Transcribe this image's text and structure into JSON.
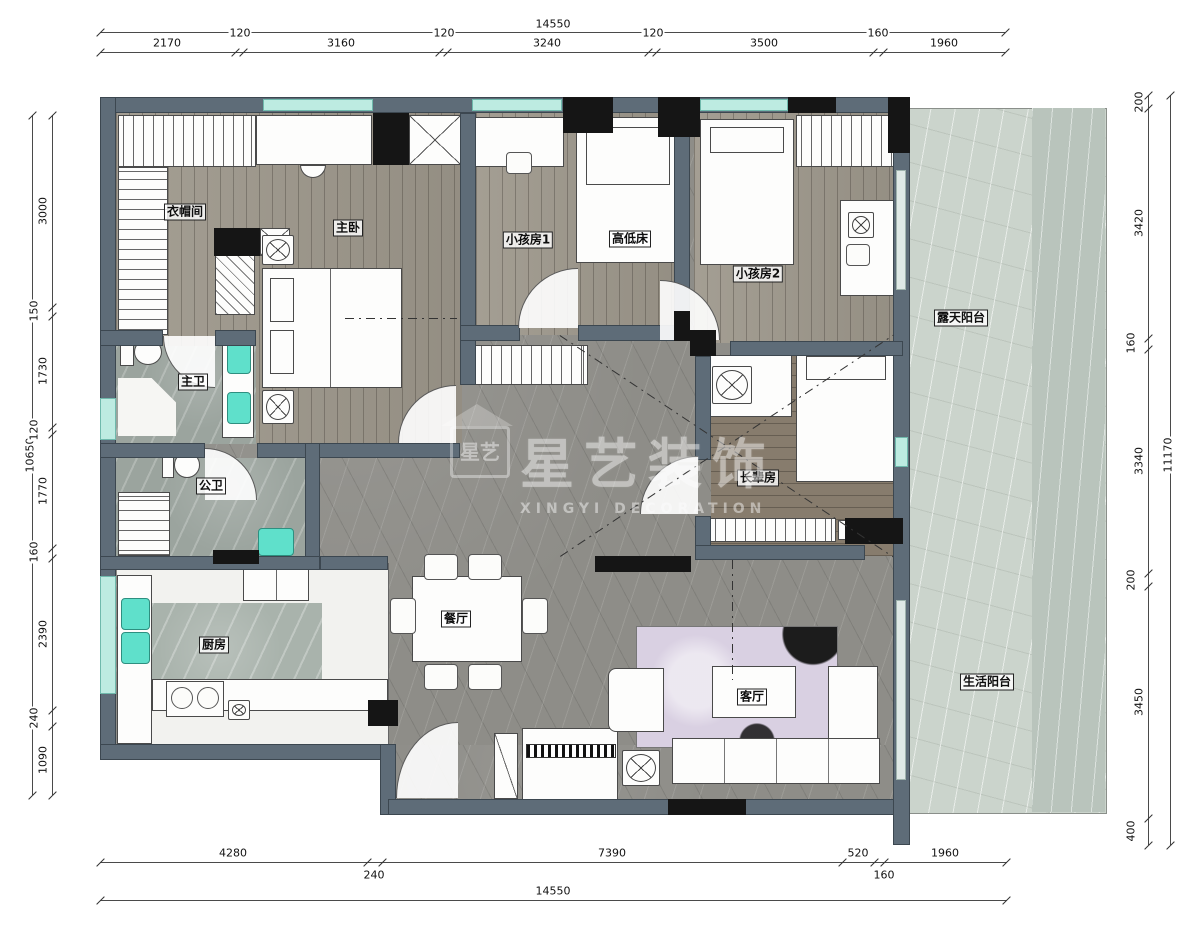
{
  "watermark": {
    "brand": "星艺装饰",
    "subtitle": "XINGYI DECORATION",
    "logo_text": "星艺"
  },
  "rooms": {
    "cloakroom": "衣帽间",
    "master_bedroom": "主卧",
    "kids_room_1": "小孩房1",
    "bunk_bed": "高低床",
    "kids_room_2": "小孩房2",
    "open_balcony": "露天阳台",
    "master_bath": "主卫",
    "guest_bath": "公卫",
    "elder_room": "长辈房",
    "kitchen": "厨房",
    "dining_room": "餐厅",
    "living_room": "客厅",
    "life_balcony": "生活阳台"
  },
  "dims": {
    "top": {
      "total": "14550",
      "segments": [
        "2170",
        "120",
        "3160",
        "120",
        "3240",
        "120",
        "3500",
        "160",
        "1960"
      ]
    },
    "bottom": {
      "total": "14550",
      "segments": [
        "4280",
        "240",
        "7390",
        "520",
        "160",
        "1960"
      ]
    },
    "left": {
      "total": "10650",
      "segments": [
        "3000",
        "150",
        "1730",
        "120",
        "1770",
        "160",
        "2390",
        "240",
        "1090"
      ]
    },
    "right": {
      "total": "11170",
      "segments": [
        "200",
        "3420",
        "160",
        "3340",
        "200",
        "3450",
        "400"
      ]
    }
  },
  "colors": {
    "wall": "#5e6c78",
    "window": "#bdebe1",
    "sink_fixture": "#5fe0cb",
    "wood_floor": "#9d978b",
    "hall_marble": "#8e8d88",
    "balcony_marble": "#cbd4cc",
    "rug": "#d9d0e2"
  }
}
